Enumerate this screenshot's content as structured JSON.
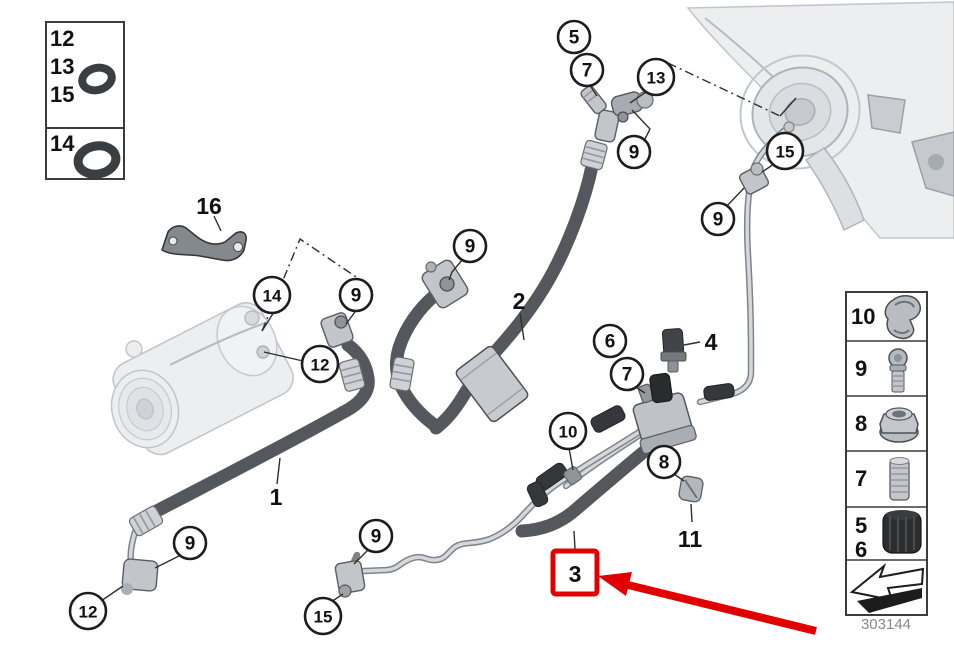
{
  "diagram": {
    "drawing_number": "303144",
    "highlight_color": "#e10000",
    "legend_left": {
      "rows": [
        {
          "labels": [
            "12",
            "13",
            "15"
          ],
          "icon": "o-ring-small"
        },
        {
          "labels": [
            "14"
          ],
          "icon": "o-ring-large"
        }
      ]
    },
    "legend_right": {
      "rows": [
        {
          "labels": [
            "10"
          ],
          "icon": "pipe-clamp"
        },
        {
          "labels": [
            "9"
          ],
          "icon": "screw-bolt"
        },
        {
          "labels": [
            "8"
          ],
          "icon": "flange-nut"
        },
        {
          "labels": [
            "7"
          ],
          "icon": "hose-connector"
        },
        {
          "labels": [
            "5",
            "6"
          ],
          "icon": "protective-cap"
        },
        {
          "labels": [],
          "icon": "direction-arrow"
        }
      ]
    },
    "callouts": [
      {
        "label": "5"
      },
      {
        "label": "7"
      },
      {
        "label": "13"
      },
      {
        "label": "9"
      },
      {
        "label": "15"
      },
      {
        "label": "9"
      },
      {
        "label": "14"
      },
      {
        "label": "9"
      },
      {
        "label": "12"
      },
      {
        "label": "9"
      },
      {
        "label": "6"
      },
      {
        "label": "7"
      },
      {
        "label": "10"
      },
      {
        "label": "8"
      },
      {
        "label": "9"
      },
      {
        "label": "12"
      },
      {
        "label": "9"
      },
      {
        "label": "15"
      }
    ],
    "labels": [
      {
        "label": "16"
      },
      {
        "label": "2"
      },
      {
        "label": "4"
      },
      {
        "label": "1"
      },
      {
        "label": "11"
      },
      {
        "label": "3"
      }
    ]
  }
}
